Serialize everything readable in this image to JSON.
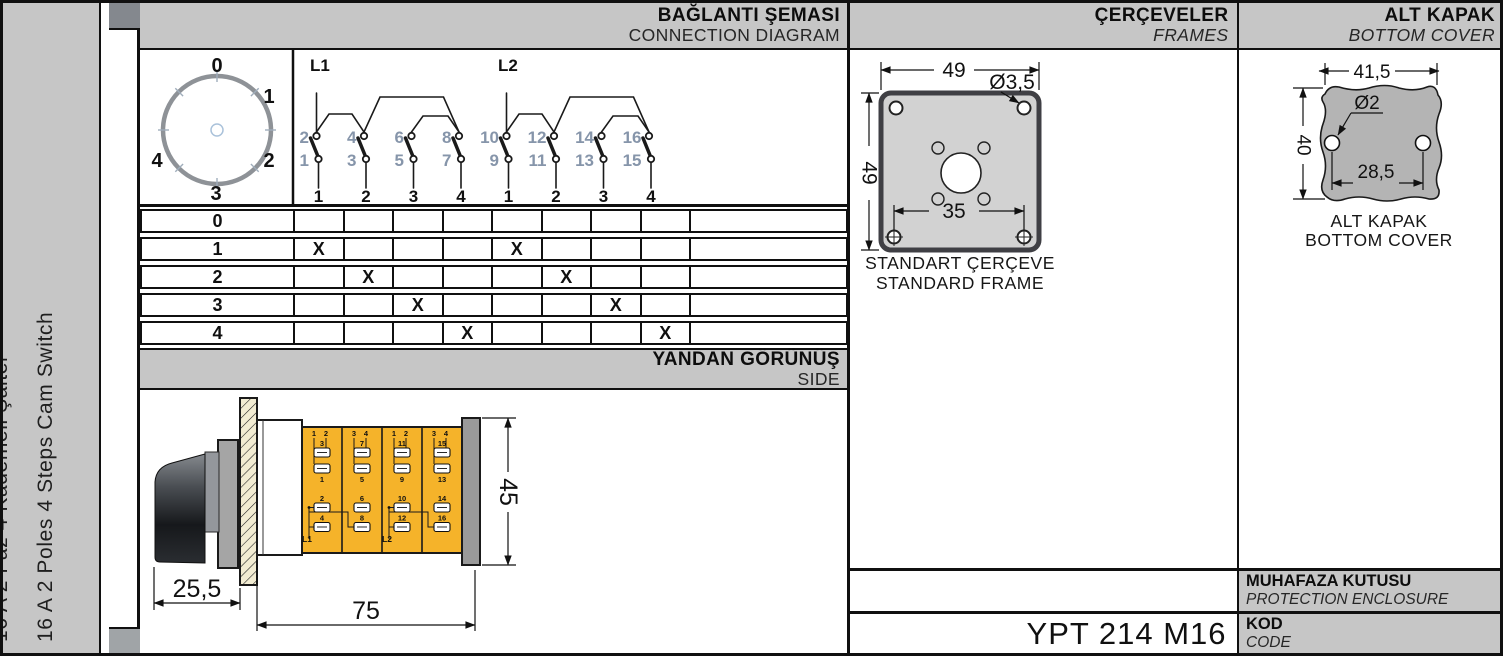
{
  "page": {
    "band_gray": "#c6c6c6",
    "accent_yellow": "#f5b32a",
    "terminal_number_color": "#8695aa"
  },
  "sidebar": {
    "title_tr": "16 A 2 Faz 4 Kademeli Şalter",
    "title_en": "16 A 2 Poles 4 Steps Cam Switch"
  },
  "headers": {
    "connection": {
      "tr": "BAĞLANTI ŞEMASI",
      "en": "CONNECTION DIAGRAM"
    },
    "frames": {
      "tr": "ÇERÇEVELER",
      "en": "FRAMES"
    },
    "bottom_cover": {
      "tr": "ALT KAPAK",
      "en": "BOTTOM COVER"
    },
    "side": {
      "tr": "YANDAN GÖRÜNÜŞ",
      "en": "SIDE"
    },
    "enclosure": {
      "tr": "MUHAFAZA KUTUSU",
      "en": "PROTECTION ENCLOSURE"
    },
    "code": {
      "tr": "KOD",
      "en": "CODE"
    }
  },
  "code_value": "YPT 214 M16",
  "dial": {
    "positions": [
      "0",
      "1",
      "2",
      "3",
      "4"
    ]
  },
  "contacts": {
    "l1": {
      "label": "L1",
      "top": [
        "2",
        "4",
        "6",
        "8"
      ],
      "bottom": [
        "1",
        "3",
        "5",
        "7"
      ],
      "positions": [
        "1",
        "2",
        "3",
        "4"
      ]
    },
    "l2": {
      "label": "L2",
      "top": [
        "10",
        "12",
        "14",
        "16"
      ],
      "bottom": [
        "9",
        "11",
        "13",
        "15"
      ],
      "positions": [
        "1",
        "2",
        "3",
        "4"
      ]
    }
  },
  "switch_table": {
    "rows": [
      {
        "label": "0",
        "cells": [
          "",
          "",
          "",
          "",
          "",
          "",
          "",
          ""
        ]
      },
      {
        "label": "1",
        "cells": [
          "X",
          "",
          "",
          "",
          "X",
          "",
          "",
          ""
        ]
      },
      {
        "label": "2",
        "cells": [
          "",
          "X",
          "",
          "",
          "",
          "X",
          "",
          ""
        ]
      },
      {
        "label": "3",
        "cells": [
          "",
          "",
          "X",
          "",
          "",
          "",
          "X",
          ""
        ]
      },
      {
        "label": "4",
        "cells": [
          "",
          "",
          "",
          "X",
          "",
          "",
          "",
          "X"
        ]
      }
    ]
  },
  "frame_drawing": {
    "width_dim": "49",
    "height_dim": "49",
    "hole_dim": "Ø3,5",
    "center_dim": "35",
    "caption_tr": "STANDART ÇERÇEVE",
    "caption_en": "STANDARD FRAME"
  },
  "cover_drawing": {
    "width_dim": "41,5",
    "height_dim": "40",
    "hole_dim": "Ø2",
    "spacing_dim": "28,5",
    "caption_tr": "ALT KAPAK",
    "caption_en": "BOTTOM COVER"
  },
  "side_drawing": {
    "knob_dim": "25,5",
    "body_dim": "75",
    "height_dim": "45",
    "l1": "L1",
    "l2": "L2",
    "sections": [
      {
        "t1": "1",
        "t2": "2",
        "up": "3",
        "low": "1",
        "b1": "2",
        "b2": "4"
      },
      {
        "t1": "3",
        "t2": "4",
        "up": "7",
        "low": "5",
        "b1": "6",
        "b2": "8"
      },
      {
        "t1": "1",
        "t2": "2",
        "up": "11",
        "low": "9",
        "b1": "10",
        "b2": "12"
      },
      {
        "t1": "3",
        "t2": "4",
        "up": "15",
        "low": "13",
        "b1": "14",
        "b2": "16"
      }
    ]
  }
}
